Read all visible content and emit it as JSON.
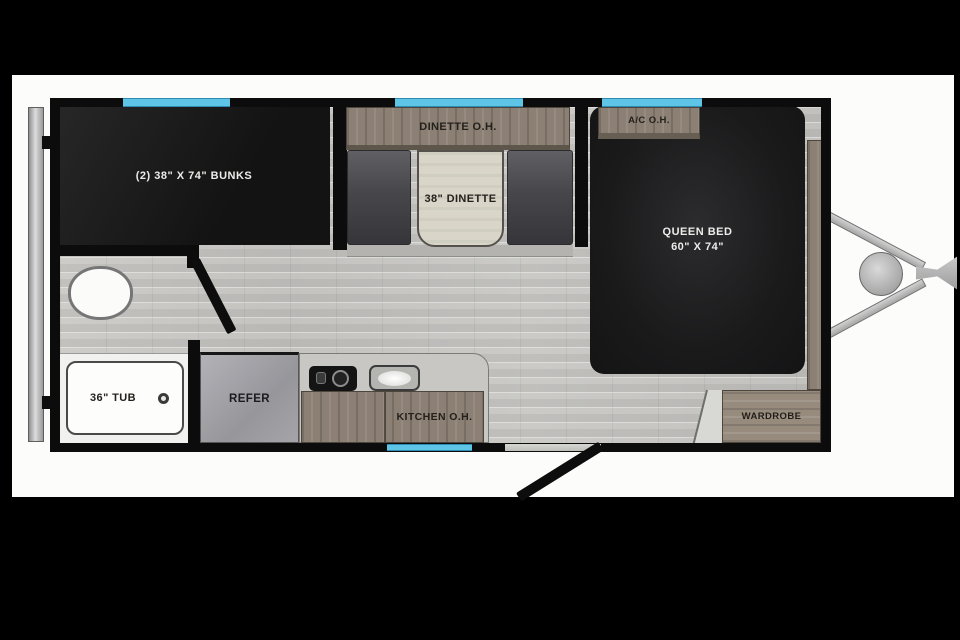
{
  "floorplan": {
    "bunk_room": {
      "bed_label": "(2) 38\" X 74\" BUNKS"
    },
    "dinette": {
      "overhead_cabinet_label": "DINETTE O.H.",
      "table_label": "38\" DINETTE"
    },
    "bedroom": {
      "overhead_cabinet_label": "A/C O.H.",
      "bed_label_line1": "QUEEN BED",
      "bed_label_line2": "60\" X 74\"",
      "wardrobe_label": "WARDROBE"
    },
    "bathroom": {
      "tub_label": "36\" TUB"
    },
    "kitchen": {
      "refrigerator_label": "REFER",
      "overhead_cabinet_label": "KITCHEN O.H."
    }
  },
  "colors": {
    "letterbox_black": "#000000",
    "photo_background": "#fcfcfb",
    "wall": "#0c0c0c",
    "window_blue": "#5fc5e7",
    "floor_tile": "#c9c8c5",
    "wood_cabinet": "#8b8073",
    "bench_gray": "#47474b",
    "bed_black": "#1a1a1c",
    "counter_gray": "#c8c7c3",
    "refrigerator_gray": "#a6a6ab",
    "fixture_white": "#fbfbfa",
    "hitch_gray": "#b9b9b9"
  }
}
